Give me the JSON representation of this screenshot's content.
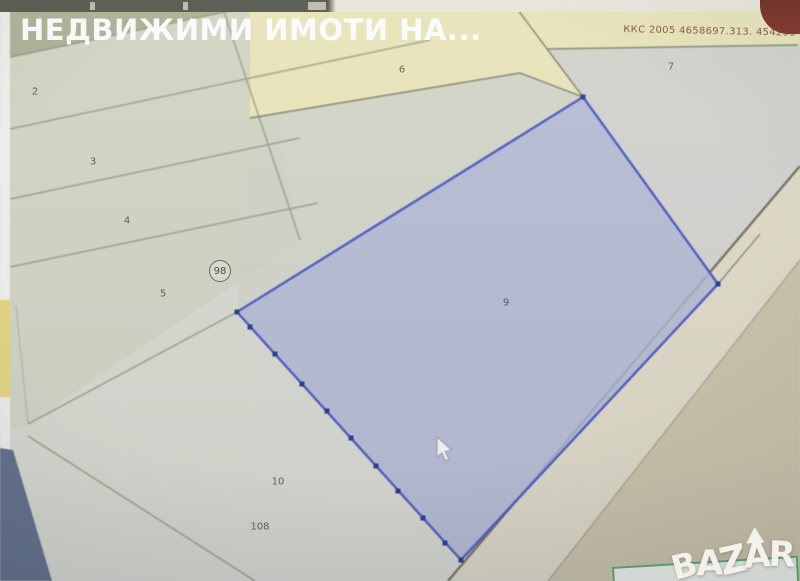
{
  "watermark": {
    "title": "НЕДВИЖИМИ ИМОТИ НА..."
  },
  "map": {
    "coordinate_label": "ККС 2005 4658697.313. 454293",
    "road_badge": "98",
    "selected_parcel": {
      "label": "9"
    },
    "parcel_labels": [
      {
        "label": "2",
        "x": 35,
        "y": 92
      },
      {
        "label": "3",
        "x": 93,
        "y": 162
      },
      {
        "label": "4",
        "x": 127,
        "y": 221
      },
      {
        "label": "5",
        "x": 163,
        "y": 294
      },
      {
        "label": "6",
        "x": 402,
        "y": 70
      },
      {
        "label": "7",
        "x": 671,
        "y": 67
      },
      {
        "label": "9",
        "x": 506,
        "y": 303
      },
      {
        "label": "10",
        "x": 278,
        "y": 482
      },
      {
        "label": "108",
        "x": 260,
        "y": 527
      }
    ]
  },
  "logo": {
    "text": "BAZAR"
  },
  "cursor": {
    "x": 437,
    "y": 438
  },
  "colors": {
    "map_base": "#d5d7cd",
    "selection_fill": "#a9b2d3",
    "selection_stroke": "#4753c4",
    "selection_vertex": "#232e8f",
    "parcel_yellow": "#e7e4b4",
    "olive_region": "#a6ab90",
    "corner_red": "#77231b",
    "coordinate_text": "#5e2218",
    "logo_white": "#f2f1ec",
    "green_box_border": "#58a468"
  }
}
